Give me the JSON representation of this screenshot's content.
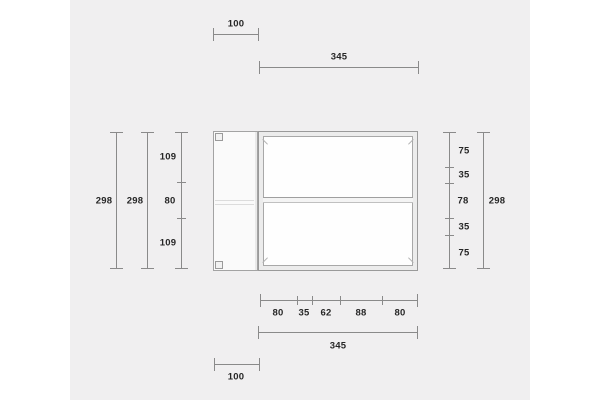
{
  "canvas": {
    "page_background": "#ffffff",
    "panel_background": "#f0eff0",
    "dimension_line_color": "#8a8a8a",
    "label_color": "#262626"
  },
  "drawing": {
    "object_name": "shelf-unit-technical-drawing",
    "dimensions": {
      "top_offset": "100",
      "top_width": "345",
      "left_height_outer": "298",
      "left_height_inner": "298",
      "left_segments": [
        "109",
        "80",
        "109"
      ],
      "right_segments": [
        "75",
        "35",
        "78",
        "35",
        "75"
      ],
      "right_height": "298",
      "bottom_segments": [
        "80",
        "35",
        "62",
        "88",
        "80"
      ],
      "bottom_width": "345",
      "bottom_offset": "100"
    }
  }
}
